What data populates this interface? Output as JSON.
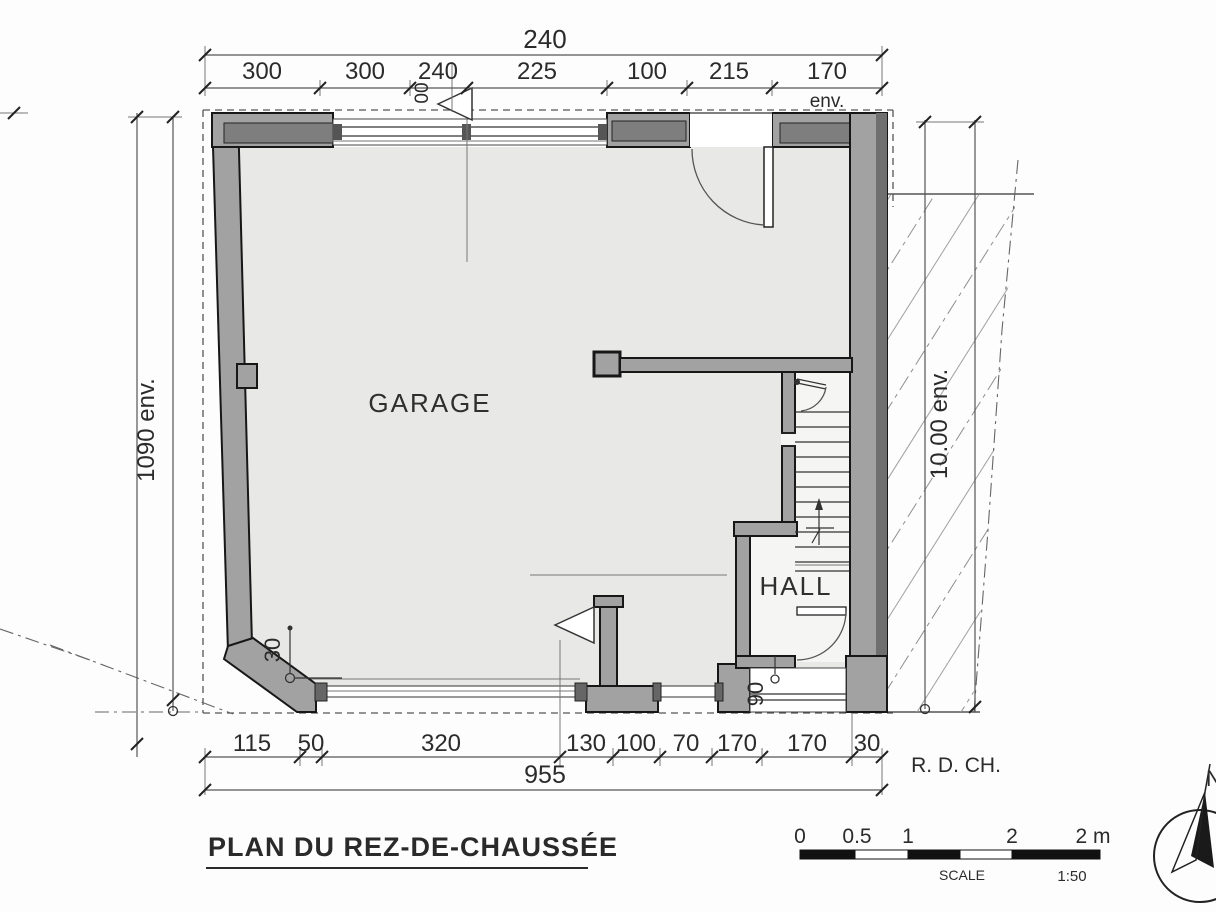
{
  "title": {
    "text": "PLAN DU REZ-DE-CHAUSSÉE"
  },
  "rooms": {
    "garage": "GARAGE",
    "hall": "HALL"
  },
  "labels": {
    "floor_code": "R. D. CH.",
    "north": "N"
  },
  "dimensions": {
    "top_overall": "240",
    "top_segments": [
      "300",
      "300",
      "240",
      "225",
      "100",
      "215",
      "170"
    ],
    "top_approx_suffix": "env.",
    "top_small_rotated": "00",
    "left_overall": "1090 env.",
    "right_overall": "10.00 env.",
    "bottom_segments": [
      "115",
      "50",
      "320",
      "130",
      "100",
      "70",
      "170",
      "170",
      "30"
    ],
    "bottom_overall": "955",
    "chamfer_offset": "30",
    "hall_door_width": "90"
  },
  "scale_bar": {
    "tick_labels": [
      "0",
      "0.5",
      "1",
      "2",
      "2 m"
    ],
    "caption": "SCALE",
    "ratio": "1:50"
  }
}
